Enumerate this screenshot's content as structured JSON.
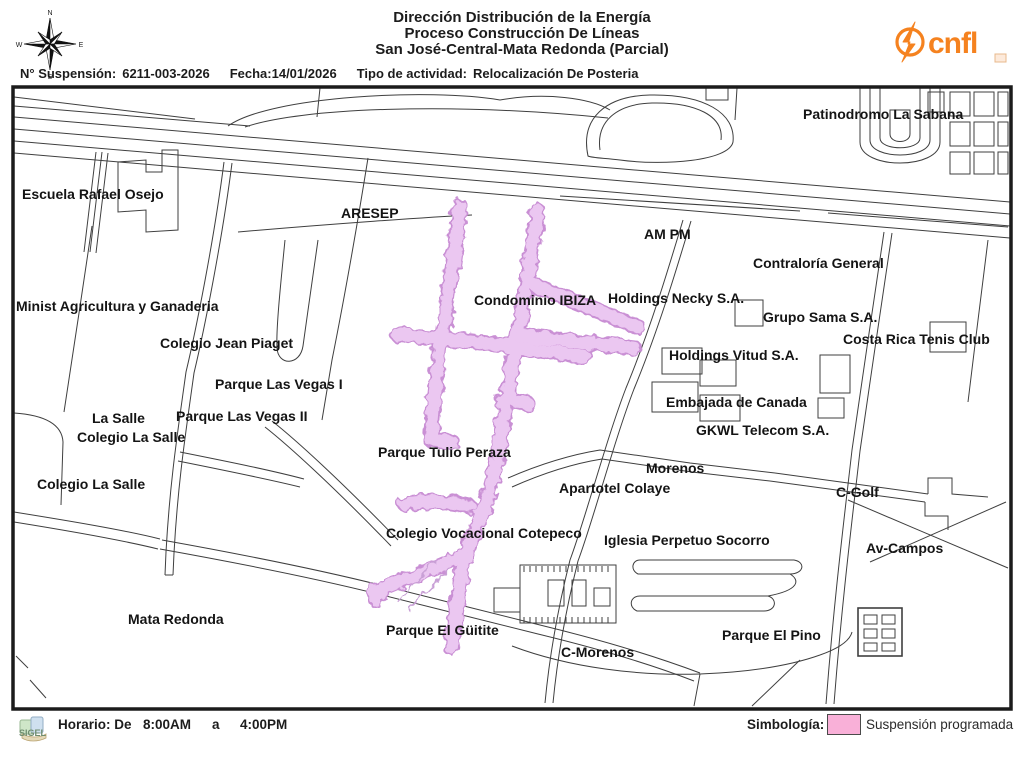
{
  "header": {
    "title_line1": "Dirección Distribución de la Energía",
    "title_line2": "Proceso Construcción De Líneas",
    "title_line3": "San José-Central-Mata Redonda (Parcial)",
    "compass": {
      "north": "N",
      "south": "S",
      "east": "E",
      "west": "W"
    },
    "logo_text": "cnfl",
    "logo_color": "#f5821f"
  },
  "info_bar": {
    "suspension_label": "N° Suspensión:",
    "suspension_number": "6211-003-2026",
    "date_label": "Fecha:",
    "date_value": "14/01/2026",
    "activity_label": "Tipo de actividad:",
    "activity_value": "Relocalización De Posteria"
  },
  "map": {
    "suspension_fill": "#edc9f2",
    "suspension_outline": "#c98fd4",
    "street_color": "#3f3f3f",
    "labels": [
      {
        "text": "Escuela Rafael Osejo",
        "x": 22,
        "y": 187
      },
      {
        "text": "ARESEP",
        "x": 341,
        "y": 206
      },
      {
        "text": "Patinodromo La Sabana",
        "x": 803,
        "y": 107
      },
      {
        "text": "AM PM",
        "x": 644,
        "y": 227
      },
      {
        "text": "Contraloría General",
        "x": 753,
        "y": 256
      },
      {
        "text": "Minist Agricultura y Ganaderia",
        "x": 16,
        "y": 299
      },
      {
        "text": "Colegio Jean Piaget",
        "x": 160,
        "y": 336
      },
      {
        "text": "Parque Las Vegas I",
        "x": 215,
        "y": 377
      },
      {
        "text": "La Salle",
        "x": 92,
        "y": 411
      },
      {
        "text": "Parque Las Vegas II",
        "x": 176,
        "y": 409
      },
      {
        "text": "Colegio La Salle",
        "x": 77,
        "y": 430
      },
      {
        "text": "Colegio La Salle",
        "x": 37,
        "y": 477
      },
      {
        "text": "Parque Tulio Peraza",
        "x": 378,
        "y": 445
      },
      {
        "text": "Condominio IBIZA",
        "x": 474,
        "y": 293
      },
      {
        "text": "Holdings Necky S.A.",
        "x": 608,
        "y": 291
      },
      {
        "text": "Grupo Sama S.A.",
        "x": 763,
        "y": 310
      },
      {
        "text": "Costa Rica Tenis Club",
        "x": 843,
        "y": 332
      },
      {
        "text": "Holdings Vitud S.A.",
        "x": 669,
        "y": 348
      },
      {
        "text": "Embajada de Canada",
        "x": 666,
        "y": 395
      },
      {
        "text": "GKWL Telecom S.A.",
        "x": 696,
        "y": 423
      },
      {
        "text": "Morenos",
        "x": 646,
        "y": 461
      },
      {
        "text": "Apartotel Colaye",
        "x": 559,
        "y": 481
      },
      {
        "text": "C-Golf",
        "x": 836,
        "y": 485
      },
      {
        "text": "Colegio Vocacional Cotepeco",
        "x": 386,
        "y": 526
      },
      {
        "text": "Iglesia Perpetuo Socorro",
        "x": 604,
        "y": 533
      },
      {
        "text": "Av-Campos",
        "x": 866,
        "y": 541
      },
      {
        "text": "Mata Redonda",
        "x": 128,
        "y": 612
      },
      {
        "text": "Parque El Güitite",
        "x": 386,
        "y": 623
      },
      {
        "text": "C-Morenos",
        "x": 561,
        "y": 645
      },
      {
        "text": "Parque El Pino",
        "x": 722,
        "y": 628
      }
    ]
  },
  "footer": {
    "sigel_text": "SIGEL",
    "schedule_label": "Horario: De",
    "schedule_start": "8:00AM",
    "schedule_a": "a",
    "schedule_end": "4:00PM",
    "legend_label": "Simbología:",
    "legend_item": "Suspensión programada",
    "legend_swatch_color": "#f9b0d8"
  }
}
